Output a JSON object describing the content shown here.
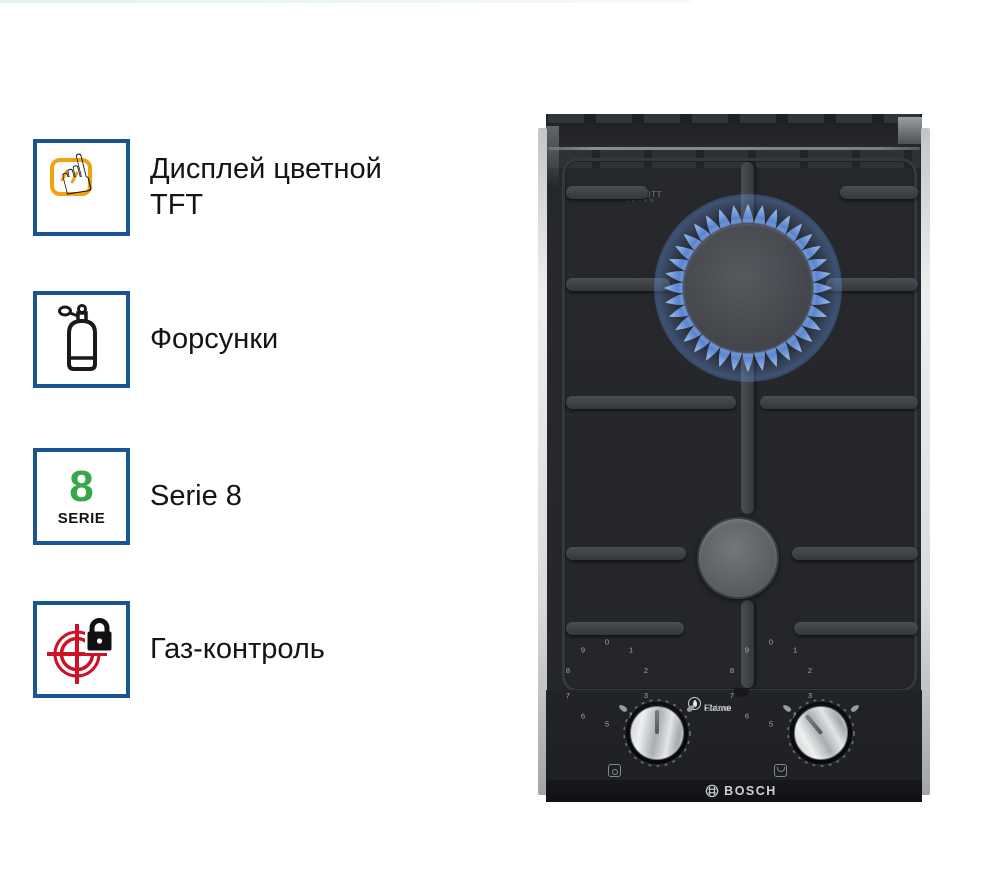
{
  "features": [
    {
      "icon": "touch-display-icon",
      "label": "Дисплей цветной TFT"
    },
    {
      "icon": "gas-cylinder-icon",
      "label": "Форсунки"
    },
    {
      "icon": "serie-8-badge-icon",
      "label": "Serie 8",
      "badge": {
        "number": "8",
        "caption": "SERIE"
      }
    },
    {
      "icon": "gas-control-icon",
      "label": "Газ-контроль"
    }
  ],
  "hob": {
    "glass_brand": {
      "line1": "SCHOTT",
      "line2": "CERAN"
    },
    "flame_select": {
      "bold": "Flame",
      "light": "Select"
    },
    "brand": "BOSCH",
    "knob_scale": [
      "0",
      "1",
      "2",
      "3",
      "4",
      "5",
      "6",
      "7",
      "8",
      "9"
    ],
    "knobs": [
      {
        "name": "front-burner-knob",
        "angle_deg": 0
      },
      {
        "name": "rear-burner-knob",
        "angle_deg": -40
      }
    ],
    "burners": [
      {
        "name": "rear-burner",
        "state": "lit"
      },
      {
        "name": "front-burner",
        "state": "off"
      }
    ]
  },
  "colors": {
    "feature_border": "#1a5493",
    "accent_orange": "#f2a20c",
    "accent_green": "#35a849",
    "accent_red": "#ce1126",
    "flame_blue": "#5b8ad8",
    "text": "#141414"
  }
}
